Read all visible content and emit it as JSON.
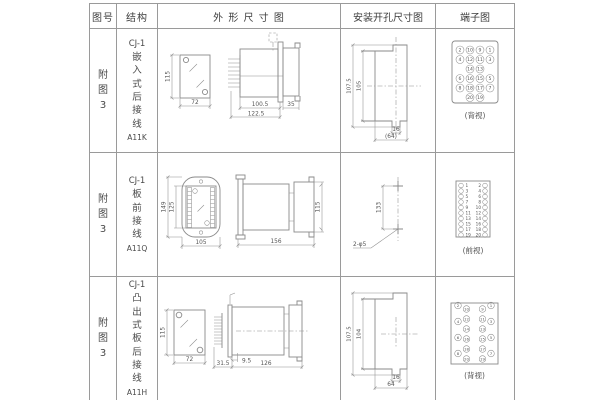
{
  "page": {
    "background": "#ffffff",
    "table_line_color": "#9a9a9a",
    "drawing_line_color": "#8a8a8a",
    "text_color": "#4a4a4a"
  },
  "table": {
    "headers": {
      "figure_no": "图号",
      "structure": "结构",
      "outline": "外 形 尺 寸 图",
      "install": "安装开孔尺寸图",
      "terminal": "端子图"
    },
    "rows": [
      {
        "figure_label": "附图3",
        "structure": {
          "model": "CJ-1",
          "type": "嵌入式后接线",
          "code": "A11K"
        },
        "outline_dims": {
          "height": "115",
          "width": "72",
          "depth_main": "100.5",
          "depth_total": "122.5",
          "depth_rear": "35"
        },
        "install_dims": {
          "outer_height": "107.5",
          "inner_height": "105",
          "slot_width": "16",
          "total_width": "(64)"
        },
        "terminal": {
          "caption": "(背视)",
          "numbers": {
            "r1": [
              "2",
              "10",
              "9",
              "1"
            ],
            "r2": [
              "4",
              "12",
              "11",
              "3"
            ],
            "r3": [
              "14",
              "13"
            ],
            "r4": [
              "6",
              "16",
              "15",
              "5"
            ],
            "r5": [
              "8",
              "18",
              "17",
              "7"
            ],
            "r6": [
              "20",
              "19"
            ]
          }
        }
      },
      {
        "figure_label": "附图3",
        "structure": {
          "model": "CJ-1",
          "type": "板前接线",
          "code": "A11Q"
        },
        "outline_dims": {
          "outer_height": "149",
          "inner_height": "125",
          "width": "105",
          "depth": "156",
          "side_height": "115"
        },
        "install_dims": {
          "hole_spacing": "133",
          "hole_label": "2-φ5"
        },
        "terminal": {
          "caption": "(前视)",
          "left": [
            "1",
            "3",
            "5",
            "7",
            "9",
            "11",
            "13",
            "15",
            "17",
            "19"
          ],
          "right": [
            "2",
            "4",
            "6",
            "8",
            "10",
            "12",
            "14",
            "16",
            "18",
            "20"
          ]
        }
      },
      {
        "figure_label": "附图3",
        "structure": {
          "model": "CJ-1",
          "type": "凸出式板后接线",
          "code": "A11H"
        },
        "outline_dims": {
          "height": "115",
          "width": "72",
          "flange_offset": "9.5",
          "front_depth": "31.5",
          "body_depth": "126"
        },
        "install_dims": {
          "outer_height": "107.5",
          "inner_height": "104",
          "slot_width": "16",
          "total_width": "64"
        },
        "terminal": {
          "caption": "(背视)",
          "outer_left": [
            "2",
            "4",
            "6",
            "8"
          ],
          "inner_left": [
            "10",
            "12",
            "14",
            "16",
            "18",
            "20"
          ],
          "inner_right": [
            "9",
            "11",
            "13",
            "15",
            "17",
            "19"
          ],
          "outer_right": [
            "1",
            "3",
            "5",
            "7"
          ]
        }
      }
    ]
  }
}
